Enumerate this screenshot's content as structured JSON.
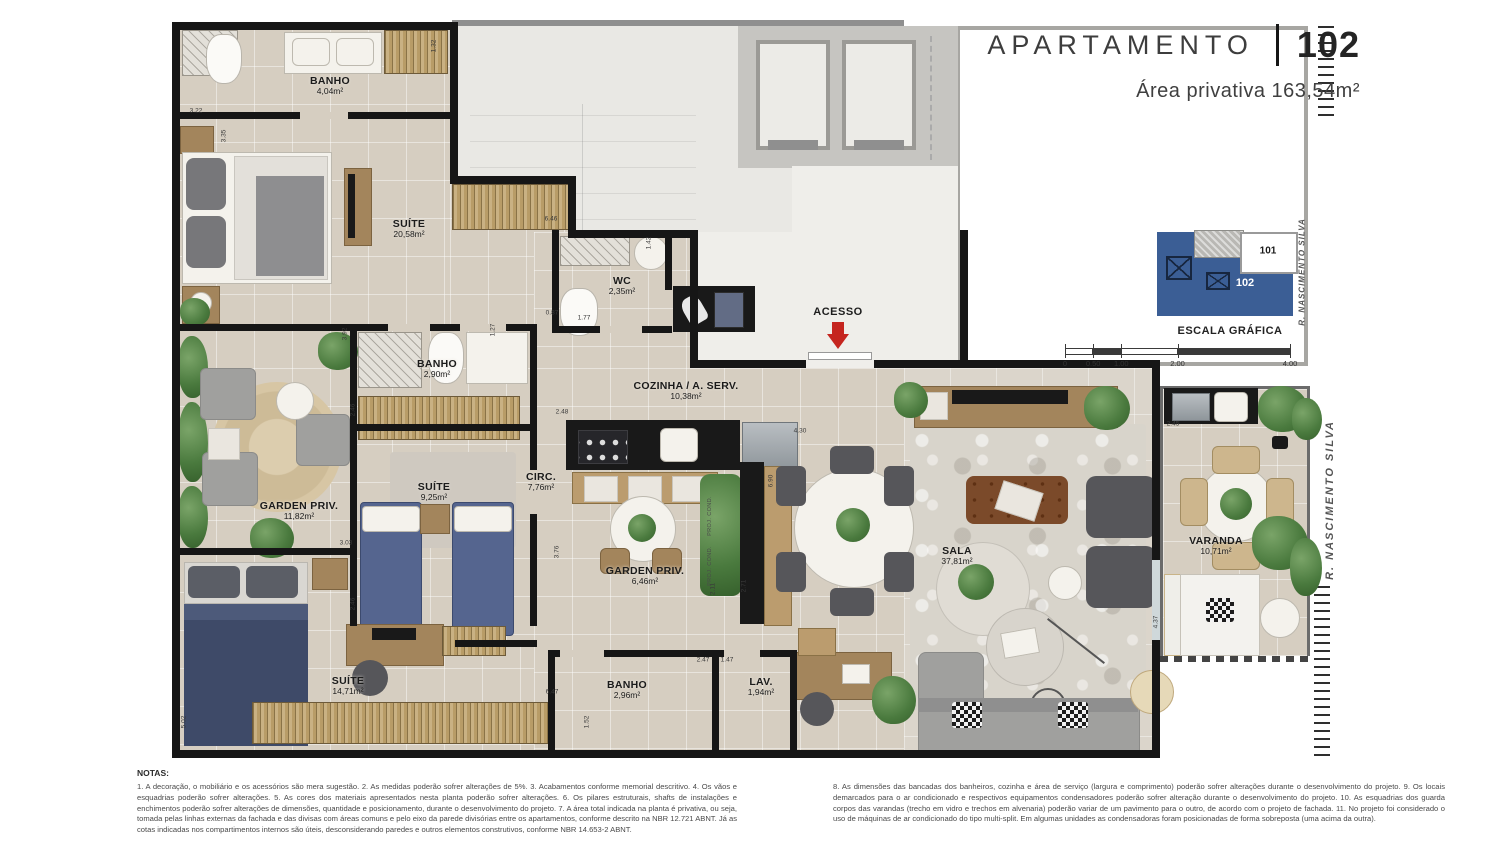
{
  "header": {
    "title": "APARTAMENTO",
    "unit_number": "102",
    "area_line": "Área privativa 163,54m²"
  },
  "key_plan": {
    "unit_current": "102",
    "unit_neighbor": "101",
    "street": "R. NASCIMENTO SILVA"
  },
  "scale": {
    "title": "ESCALA GRÁFICA",
    "ticks": [
      {
        "label": "0",
        "v": 0
      },
      {
        "label": "0.50",
        "v": 0.5
      },
      {
        "label": "1.00",
        "v": 1
      },
      {
        "label": "2.00",
        "v": 2
      },
      {
        "label": "4.00",
        "v": 4
      }
    ]
  },
  "plan": {
    "street_label": "R. NASCIMENTO SILVA",
    "access_label": "ACESSO",
    "rooms": [
      {
        "id": "banho-superior",
        "name": "BANHO",
        "area": "4,04m²",
        "x": 330,
        "y": 86
      },
      {
        "id": "suite-master",
        "name": "SUÍTE",
        "area": "20,58m²",
        "x": 409,
        "y": 229
      },
      {
        "id": "wc",
        "name": "WC",
        "area": "2,35m²",
        "x": 622,
        "y": 286
      },
      {
        "id": "banho-meio",
        "name": "BANHO",
        "area": "2,90m²",
        "x": 437,
        "y": 369
      },
      {
        "id": "cozinha-a-serv",
        "name": "COZINHA / A. SERV.",
        "area": "10,38m²",
        "x": 686,
        "y": 391
      },
      {
        "id": "garden-priv-1",
        "name": "GARDEN PRIV.",
        "area": "11,82m²",
        "x": 299,
        "y": 511
      },
      {
        "id": "suite-2",
        "name": "SUÍTE",
        "area": "9,25m²",
        "x": 434,
        "y": 492
      },
      {
        "id": "circ",
        "name": "CIRC.",
        "area": "7,76m²",
        "x": 541,
        "y": 482
      },
      {
        "id": "garden-priv-2",
        "name": "GARDEN PRIV.",
        "area": "6,46m²",
        "x": 645,
        "y": 576
      },
      {
        "id": "sala",
        "name": "SALA",
        "area": "37,81m²",
        "x": 957,
        "y": 556
      },
      {
        "id": "varanda",
        "name": "VARANDA",
        "area": "10,71m²",
        "x": 1216,
        "y": 546
      },
      {
        "id": "suite-3",
        "name": "SUÍTE",
        "area": "14,71m²",
        "x": 348,
        "y": 686
      },
      {
        "id": "banho-inferior",
        "name": "BANHO",
        "area": "2,96m²",
        "x": 627,
        "y": 690
      },
      {
        "id": "lav",
        "name": "LAV.",
        "area": "1,94m²",
        "x": 761,
        "y": 687
      }
    ],
    "dims": [
      {
        "v": "3.22",
        "x": 196,
        "y": 111,
        "r": 0
      },
      {
        "v": "3.35",
        "x": 224,
        "y": 136,
        "r": 1
      },
      {
        "v": "1.32",
        "x": 434,
        "y": 46,
        "r": 1
      },
      {
        "v": "6.46",
        "x": 551,
        "y": 219,
        "r": 0
      },
      {
        "v": "1.42",
        "x": 649,
        "y": 243,
        "r": 1
      },
      {
        "v": "0.87",
        "x": 552,
        "y": 313,
        "r": 0
      },
      {
        "v": "1.77",
        "x": 584,
        "y": 318,
        "r": 0
      },
      {
        "v": "1.27",
        "x": 493,
        "y": 330,
        "r": 1
      },
      {
        "v": "3.92",
        "x": 345,
        "y": 334,
        "r": 1
      },
      {
        "v": "2.46",
        "x": 353,
        "y": 410,
        "r": 1
      },
      {
        "v": "2.48",
        "x": 562,
        "y": 412,
        "r": 0
      },
      {
        "v": "3.76",
        "x": 557,
        "y": 552,
        "r": 1
      },
      {
        "v": "3.03",
        "x": 346,
        "y": 543,
        "r": 0
      },
      {
        "v": "2.46",
        "x": 353,
        "y": 604,
        "r": 1
      },
      {
        "v": "5.02",
        "x": 184,
        "y": 722,
        "r": 1
      },
      {
        "v": "6.47",
        "x": 552,
        "y": 692,
        "r": 0
      },
      {
        "v": "1.52",
        "x": 587,
        "y": 722,
        "r": 1
      },
      {
        "v": "2.47",
        "x": 703,
        "y": 660,
        "r": 0
      },
      {
        "v": "1.47",
        "x": 727,
        "y": 660,
        "r": 0
      },
      {
        "v": "4.30",
        "x": 800,
        "y": 431,
        "r": 0
      },
      {
        "v": "6.90",
        "x": 771,
        "y": 481,
        "r": 1
      },
      {
        "v": "2.71",
        "x": 744,
        "y": 586,
        "r": 1
      },
      {
        "v": "2.11",
        "x": 713,
        "y": 589,
        "r": 1
      },
      {
        "v": "2.45",
        "x": 1173,
        "y": 424,
        "r": 0
      },
      {
        "v": "4.37",
        "x": 1156,
        "y": 622,
        "r": 1
      }
    ],
    "annotations": [
      {
        "text": "PROJ. COND.",
        "x": 710,
        "y": 516
      },
      {
        "text": "PROJ. COND.",
        "x": 710,
        "y": 566
      }
    ]
  },
  "notes": {
    "heading": "NOTAS:",
    "col_left": "1. A decoração, o mobiliário e os acessórios são mera sugestão. 2. As medidas poderão sofrer alterações de 5%. 3. Acabamentos conforme memorial descritivo. 4. Os vãos e esquadrias poderão sofrer alterações. 5. As cores dos materiais apresentados nesta planta poderão sofrer alterações. 6. Os pilares estruturais, shafts de instalações e enchimentos poderão sofrer alterações de dimensões, quantidade e posicionamento, durante o desenvolvimento do projeto. 7. A área total indicada na planta é privativa, ou seja, tomada pelas linhas externas da fachada e das divisas com áreas comuns e pelo eixo da parede divisórias entre os apartamentos, conforme descrito na NBR 12.721 ABNT. Já as cotas indicadas nos compartimentos internos são úteis, desconsiderando paredes e outros elementos construtivos, conforme NBR 14.653-2 ABNT.",
    "col_right": "8. As dimensões das bancadas dos banheiros, cozinha e área de serviço (largura e comprimento) poderão sofrer alterações durante o desenvolvimento do projeto. 9. Os locais demarcados para o ar condicionado e respectivos equipamentos condensadores poderão sofrer alteração durante o desenvolvimento do projeto. 10. As esquadrias dos guarda corpos das varandas (trecho em vidro e trechos em alvenaria) poderão variar de um pavimento para o outro, de acordo com o projeto de fachada. 11. No projeto foi considerado o uso de máquinas de ar condicionado do tipo multi-split. Em algumas unidades as condensadoras foram posicionadas de forma sobreposta (uma acima da outra).",
    "colors": {
      "keyplan_blue": "#3b5e95",
      "access_arrow_red": "#c5251f"
    }
  }
}
